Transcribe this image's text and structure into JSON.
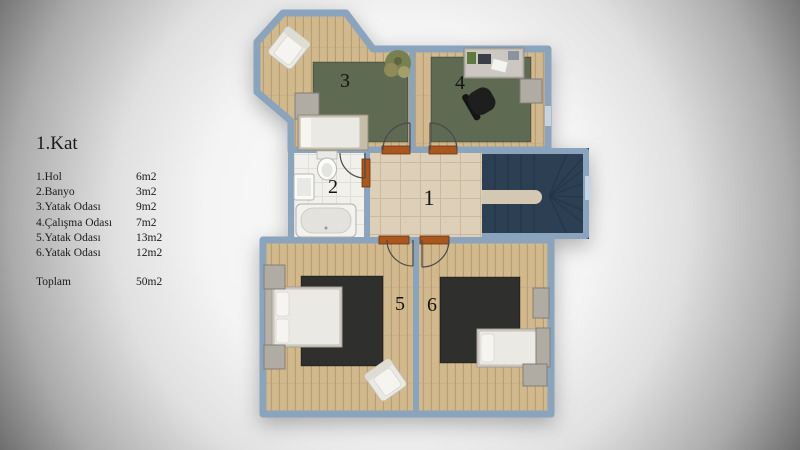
{
  "legend": {
    "title": "1.Kat",
    "items": [
      {
        "name": "1.Hol",
        "area": "6m2"
      },
      {
        "name": "2.Banyo",
        "area": "3m2"
      },
      {
        "name": "3.Yatak Odası",
        "area": "9m2"
      },
      {
        "name": "4.Çalışma Odası",
        "area": "7m2"
      },
      {
        "name": "5.Yatak Odası",
        "area": "13m2"
      },
      {
        "name": "6.Yatak Odası",
        "area": "12m2"
      }
    ],
    "total_label": "Toplam",
    "total_area": "50m2"
  },
  "rooms": [
    {
      "number": "1"
    },
    {
      "number": "2"
    },
    {
      "number": "3"
    },
    {
      "number": "4"
    },
    {
      "number": "5"
    },
    {
      "number": "6"
    }
  ],
  "colors": {
    "background_center": "#fcfcfc",
    "background_edge": "#6e6e6e",
    "wall": "#8aa4bd",
    "wood": "#d2b88d",
    "wood_line": "#b99f74",
    "rug_green": "#5e6a52",
    "rug_dark": "#2f2f2d",
    "hall_floor": "#ddcfb8",
    "hall_line": "#c9b99f",
    "bath_floor": "#f2f0eb",
    "bath_line": "#e0ded8",
    "stairs": "#2d4053",
    "stair_line": "#223447",
    "landing": "#d5c8b2",
    "door": "#a9571f",
    "furniture_white": "#ebe9e4",
    "furniture_gray": "#b0aca4",
    "text": "#1a1a1a"
  }
}
